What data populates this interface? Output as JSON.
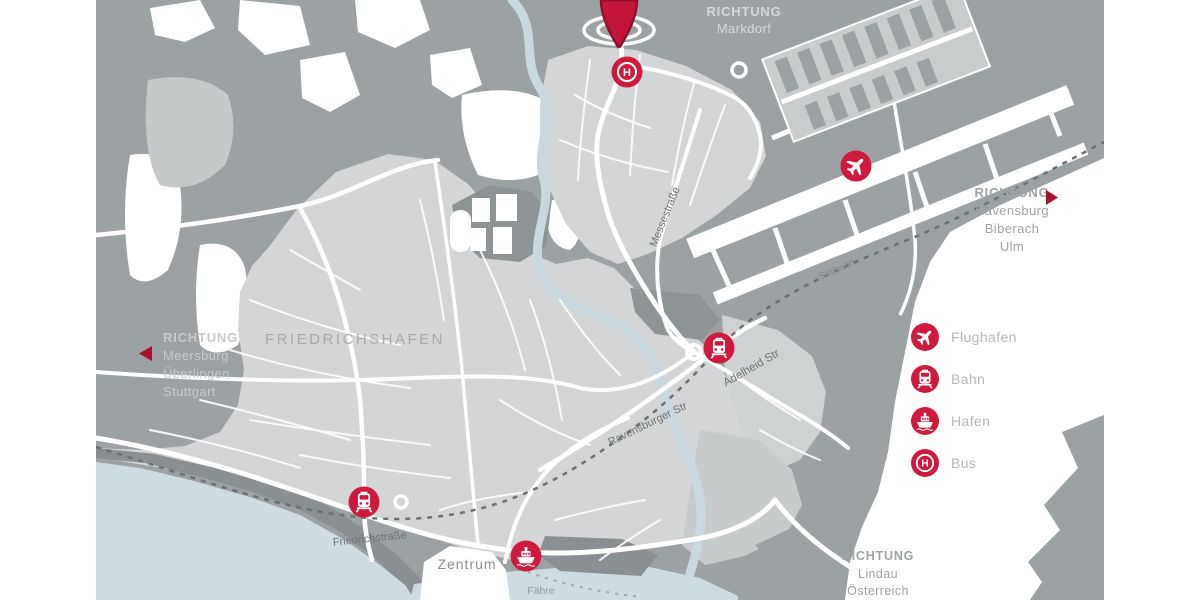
{
  "map_title": "Friedrichshafen transport map",
  "city_label": "FRIEDRICHSHAFEN",
  "directions": {
    "markdorf": {
      "heading": "RICHTUNG",
      "lines": [
        "Markdorf"
      ]
    },
    "ravensburg": {
      "heading": "RICHTUNG",
      "lines": [
        "Ravensburg",
        "Biberach",
        "Ulm"
      ]
    },
    "meersburg": {
      "heading": "RICHTUNG",
      "lines": [
        "Meersburg",
        "Überlingen",
        "Stuttgart"
      ]
    },
    "lindau": {
      "heading": "RICHTUNG",
      "lines": [
        "Lindau",
        "Österreich"
      ]
    }
  },
  "streets": {
    "messestrasse": "Messestraße",
    "adelheid": "Adelheid Str",
    "ravensburger": "Ravensburger Str",
    "suedbahn": "Südbahn",
    "friedrichstrasse": "Friedrichstraße",
    "zentrum": "Zentrum",
    "faehre": "Fähre"
  },
  "legend": {
    "items": [
      {
        "icon": "airplane-icon",
        "label": "Flughafen"
      },
      {
        "icon": "train-icon",
        "label": "Bahn"
      },
      {
        "icon": "ship-icon",
        "label": "Hafen"
      },
      {
        "icon": "bus-icon",
        "label": "Bus"
      }
    ]
  },
  "markers": {
    "bus_h": "H"
  },
  "colors": {
    "accent_red": "#CF1A3D",
    "arrow_red": "#A8122E",
    "map_gray": "#9CA1A3",
    "city_gray": "#D3D5D6",
    "dark_gray": "#8E9395",
    "water_blue": "#CEDCE1",
    "direction_text": "#9FA3A5",
    "legend_text": "#B4B8B9"
  }
}
